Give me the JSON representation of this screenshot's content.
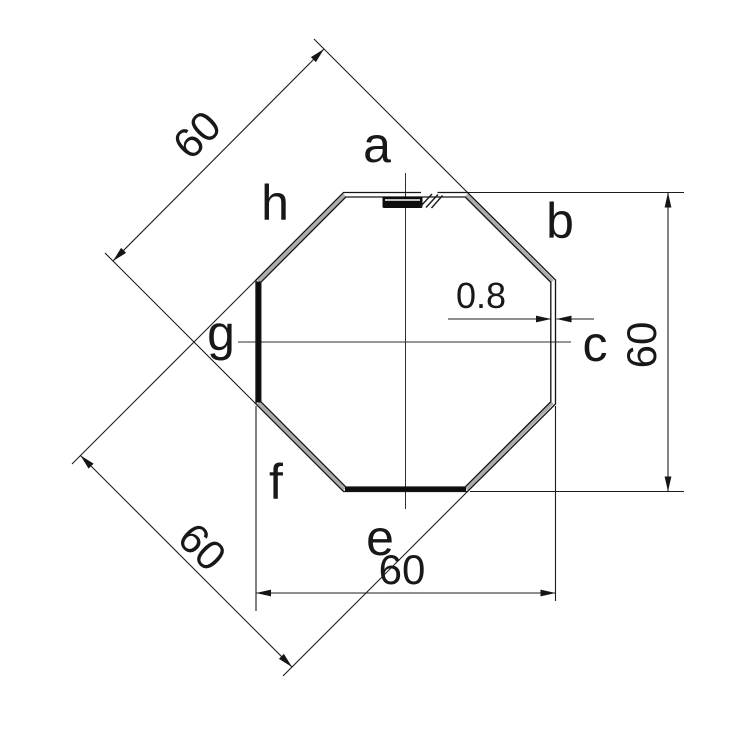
{
  "drawing": {
    "side_labels": {
      "a": "a",
      "b": "b",
      "c": "c",
      "e": "e",
      "f": "f",
      "g": "g",
      "h": "h"
    },
    "dimensions": {
      "diagonal_upper_left": "60",
      "diagonal_lower_left": "60",
      "height_right": "60",
      "width_bottom": "60",
      "wall_thickness": "0.8"
    },
    "colors": {
      "line": "#1c1c1c",
      "wall_gray": "#acacac",
      "background": "#ffffff"
    }
  }
}
